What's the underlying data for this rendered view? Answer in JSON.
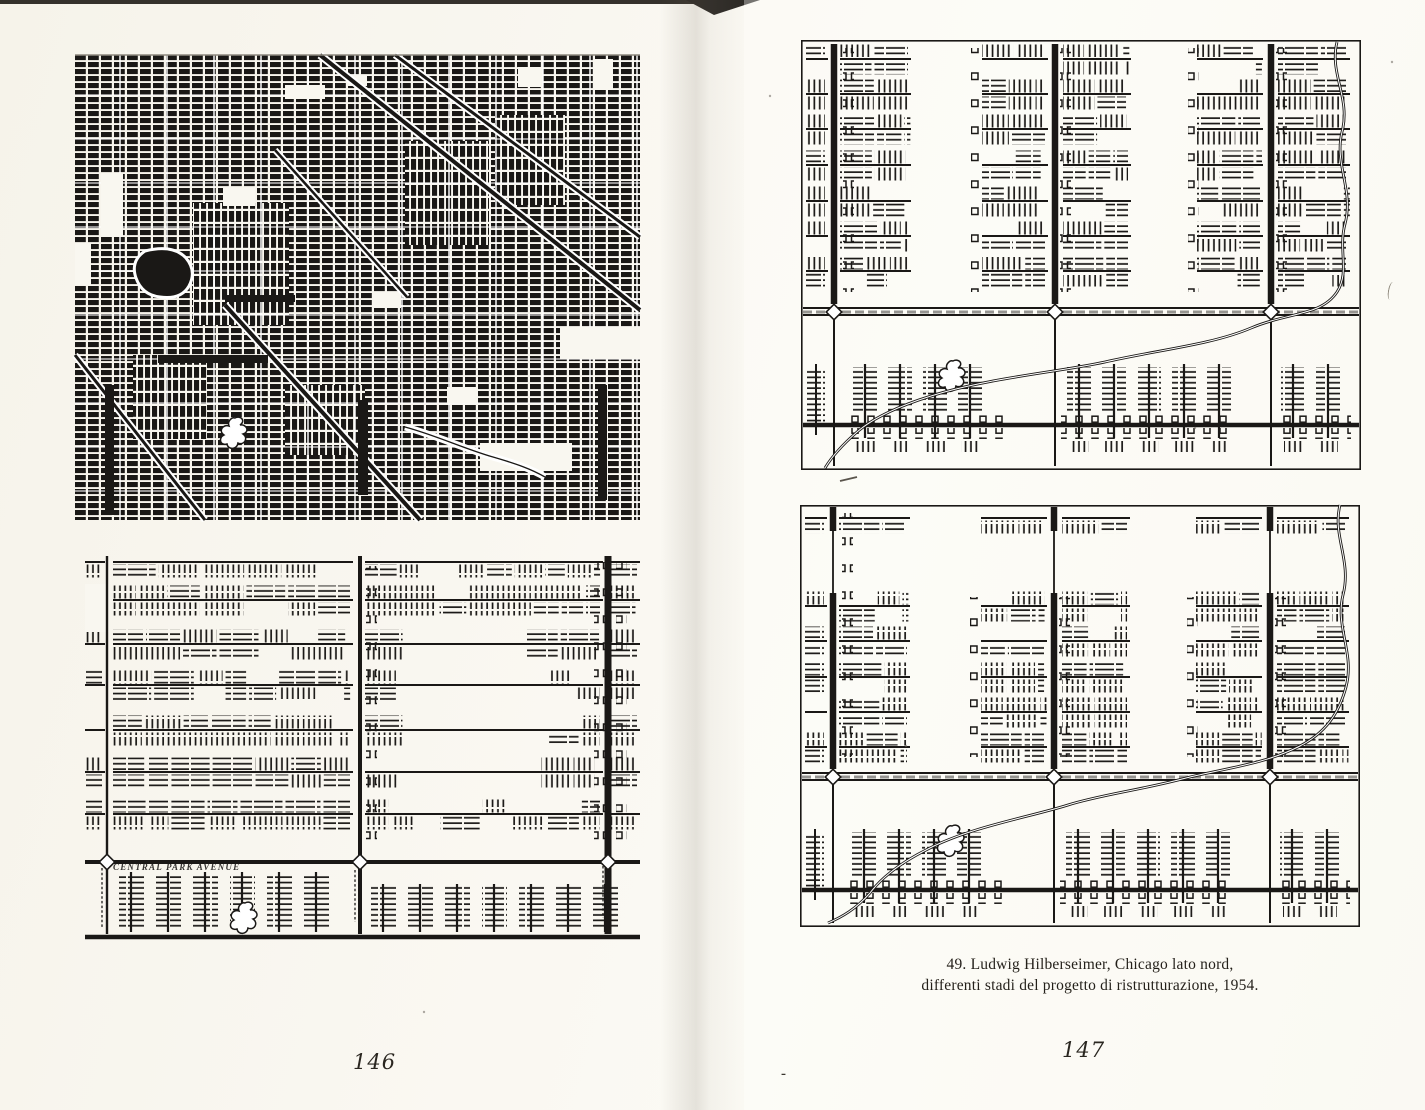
{
  "book": {
    "left_page": {
      "page_number": "146"
    },
    "right_page": {
      "page_number": "147",
      "caption": {
        "line1": "49. Ludwig Hilberseimer, Chicago lato nord,",
        "line2": "differenti stadi del progetto di ristrutturazione, 1954."
      },
      "stray_mark": "-"
    },
    "maps": {
      "map2_street_label": "CENTRAL PARK AVENUE"
    },
    "colors": {
      "ink": "#1a1816",
      "paper": "#f9f7f0"
    }
  }
}
